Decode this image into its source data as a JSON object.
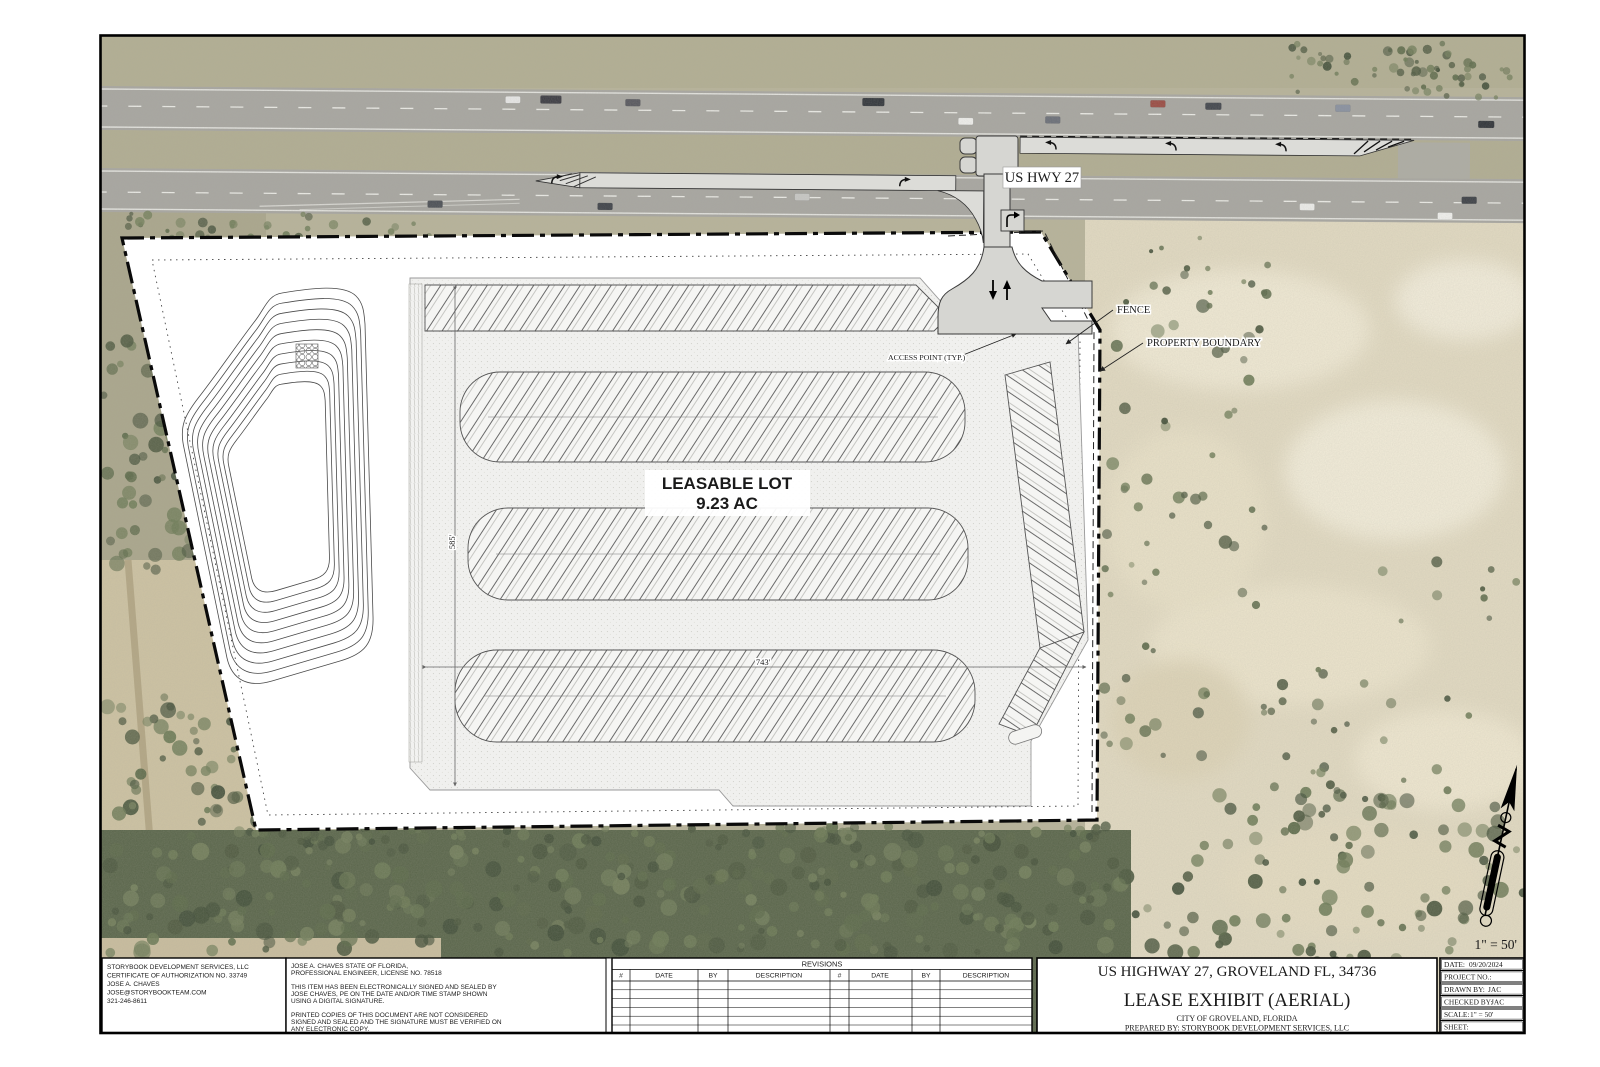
{
  "plan": {
    "highway_label": "US HWY 27",
    "fence_label": "FENCE",
    "property_boundary_label": "PROPERTY BOUNDARY",
    "access_point_label": "ACCESS POINT (TYP.)",
    "lot_title": "LEASABLE LOT",
    "lot_area": "9.23 AC",
    "dim_vertical": "585'",
    "dim_horizontal": "743'",
    "scale_note": "1\" = 50'"
  },
  "firm_block": {
    "lines": [
      "STORYBOOK DEVELOPMENT SERVICES, LLC",
      "CERTIFICATE OF AUTHORIZATION NO. 33749",
      "JOSE A. CHAVES",
      "JOSE@STORYBOOKTEAM.COM",
      "321-246-8611"
    ]
  },
  "seal_block": {
    "lines": [
      "JOSE A. CHAVES STATE OF FLORIDA,",
      "PROFESSIONAL ENGINEER, LICENSE NO. 78518",
      "",
      "THIS ITEM HAS BEEN ELECTRONICALLY SIGNED AND SEALED BY",
      "JOSE CHAVES, PE ON THE DATE AND/OR TIME STAMP SHOWN",
      "USING A DIGITAL SIGNATURE.",
      "",
      "PRINTED COPIES OF THIS DOCUMENT ARE NOT CONSIDERED",
      "SIGNED AND SEALED AND THE SIGNATURE MUST BE VERIFIED ON",
      "ANY ELECTRONIC COPY."
    ]
  },
  "revisions": {
    "title": "REVISIONS",
    "col_num": "#",
    "col_date": "DATE",
    "col_by": "BY",
    "col_desc": "DESCRIPTION"
  },
  "title_block": {
    "address": "US HIGHWAY 27, GROVELAND FL, 34736",
    "sheet_title": "LEASE EXHIBIT (AERIAL)",
    "city": "CITY OF GROVELAND, FLORIDA",
    "prepared_by": "PREPARED BY: STORYBOOK DEVELOPMENT SERVICES, LLC"
  },
  "info_block": {
    "date_label": "DATE:",
    "date_value": "09/20/2024",
    "project_label": "PROJECT NO.:",
    "project_value": "",
    "drawn_label": "DRAWN BY:",
    "drawn_value": "JAC",
    "checked_label": "CHECKED BY:",
    "checked_value": "JAC",
    "scale_label": "SCALE:",
    "scale_value": "1\" = 50'",
    "sheet_label": "SHEET:",
    "sheet_value": ""
  }
}
